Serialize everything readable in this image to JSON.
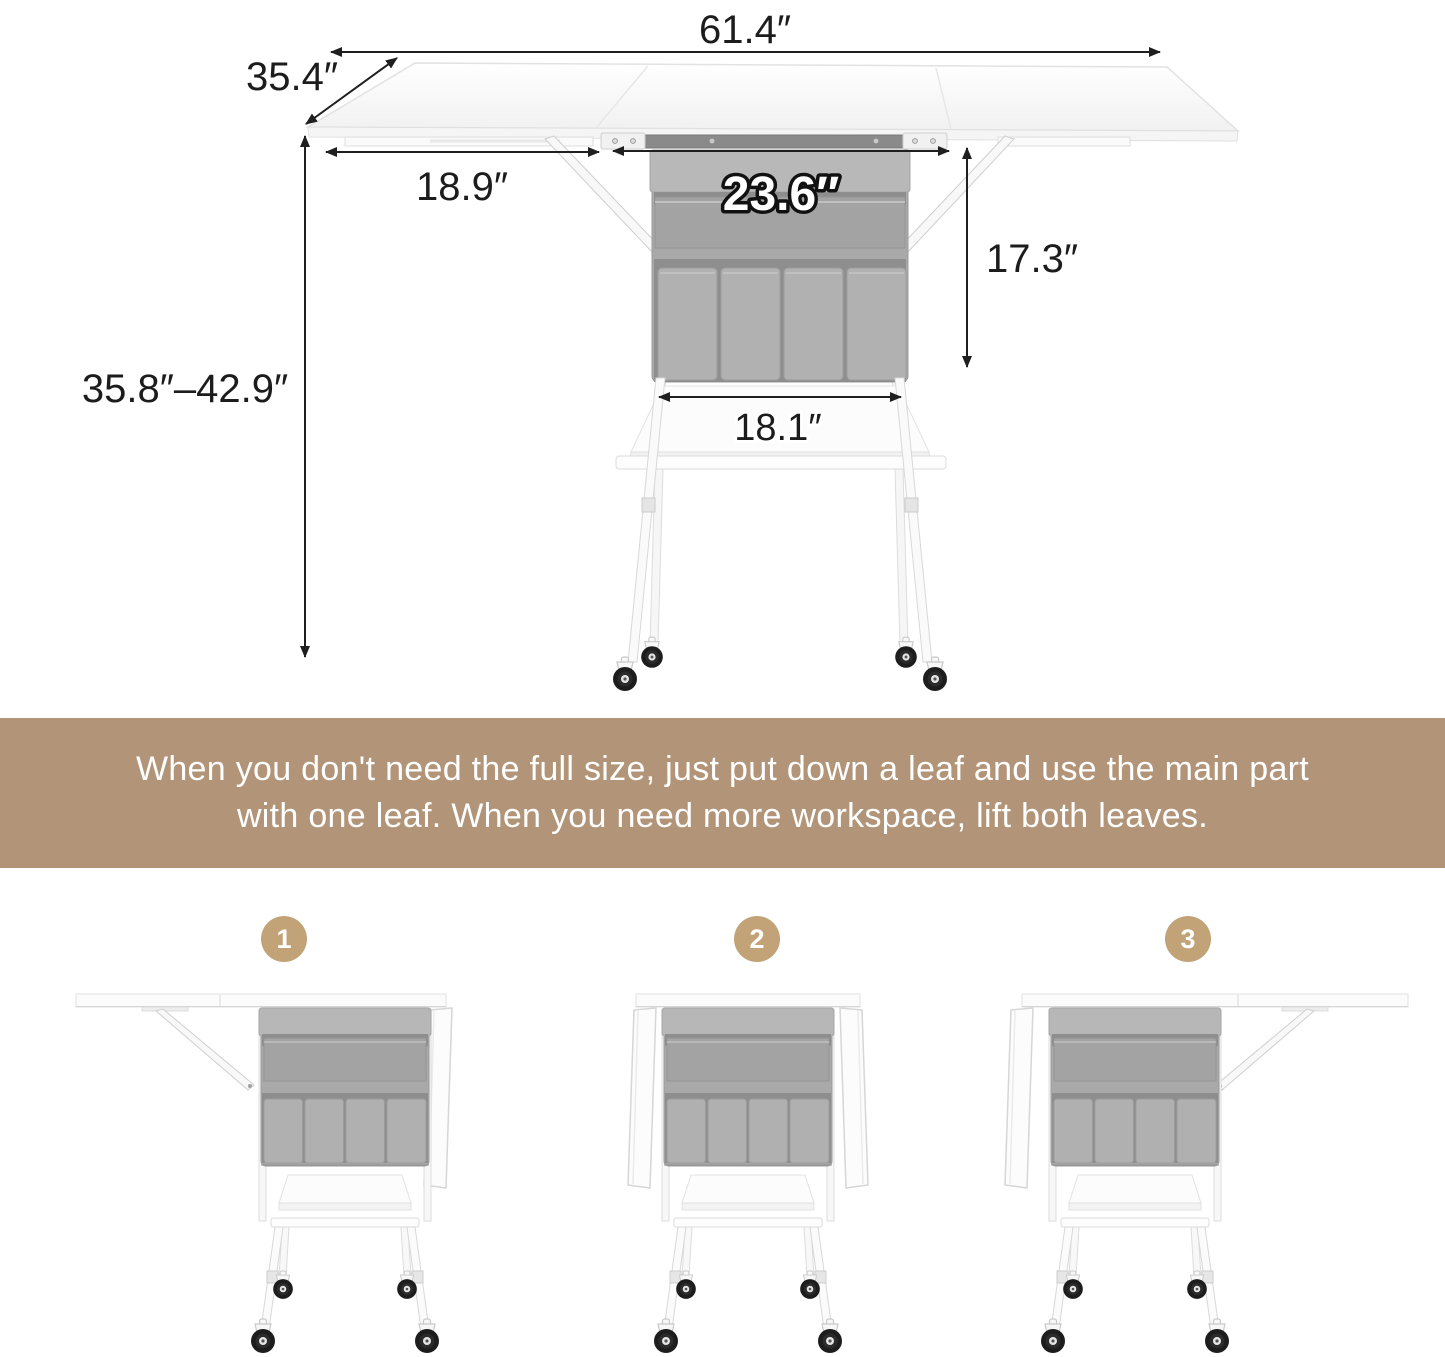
{
  "diagram": {
    "labels": {
      "total_width": "61.4″",
      "depth": "35.4″",
      "left_leaf_width": "18.9″",
      "organizer_width": "23.6″",
      "organizer_height": "17.3″",
      "height_range": "35.8″–42.9″",
      "shelf_width": "18.1″"
    }
  },
  "banner": {
    "lines": [
      "When you don't need the full size, just put down a leaf and use the main part",
      "with one leaf. When you need more workspace, lift both leaves."
    ],
    "background_color": "#b29478",
    "text_color": "#ffffff"
  },
  "steps": [
    {
      "number": "1"
    },
    {
      "number": "2"
    },
    {
      "number": "3"
    }
  ],
  "colors": {
    "badge_background": "#c2a378",
    "fabric_gray": "#a9a9a9",
    "dimension_line": "#1f1f1f",
    "table_white": "#fbfbfb",
    "caster_black": "#1d1d1d"
  }
}
